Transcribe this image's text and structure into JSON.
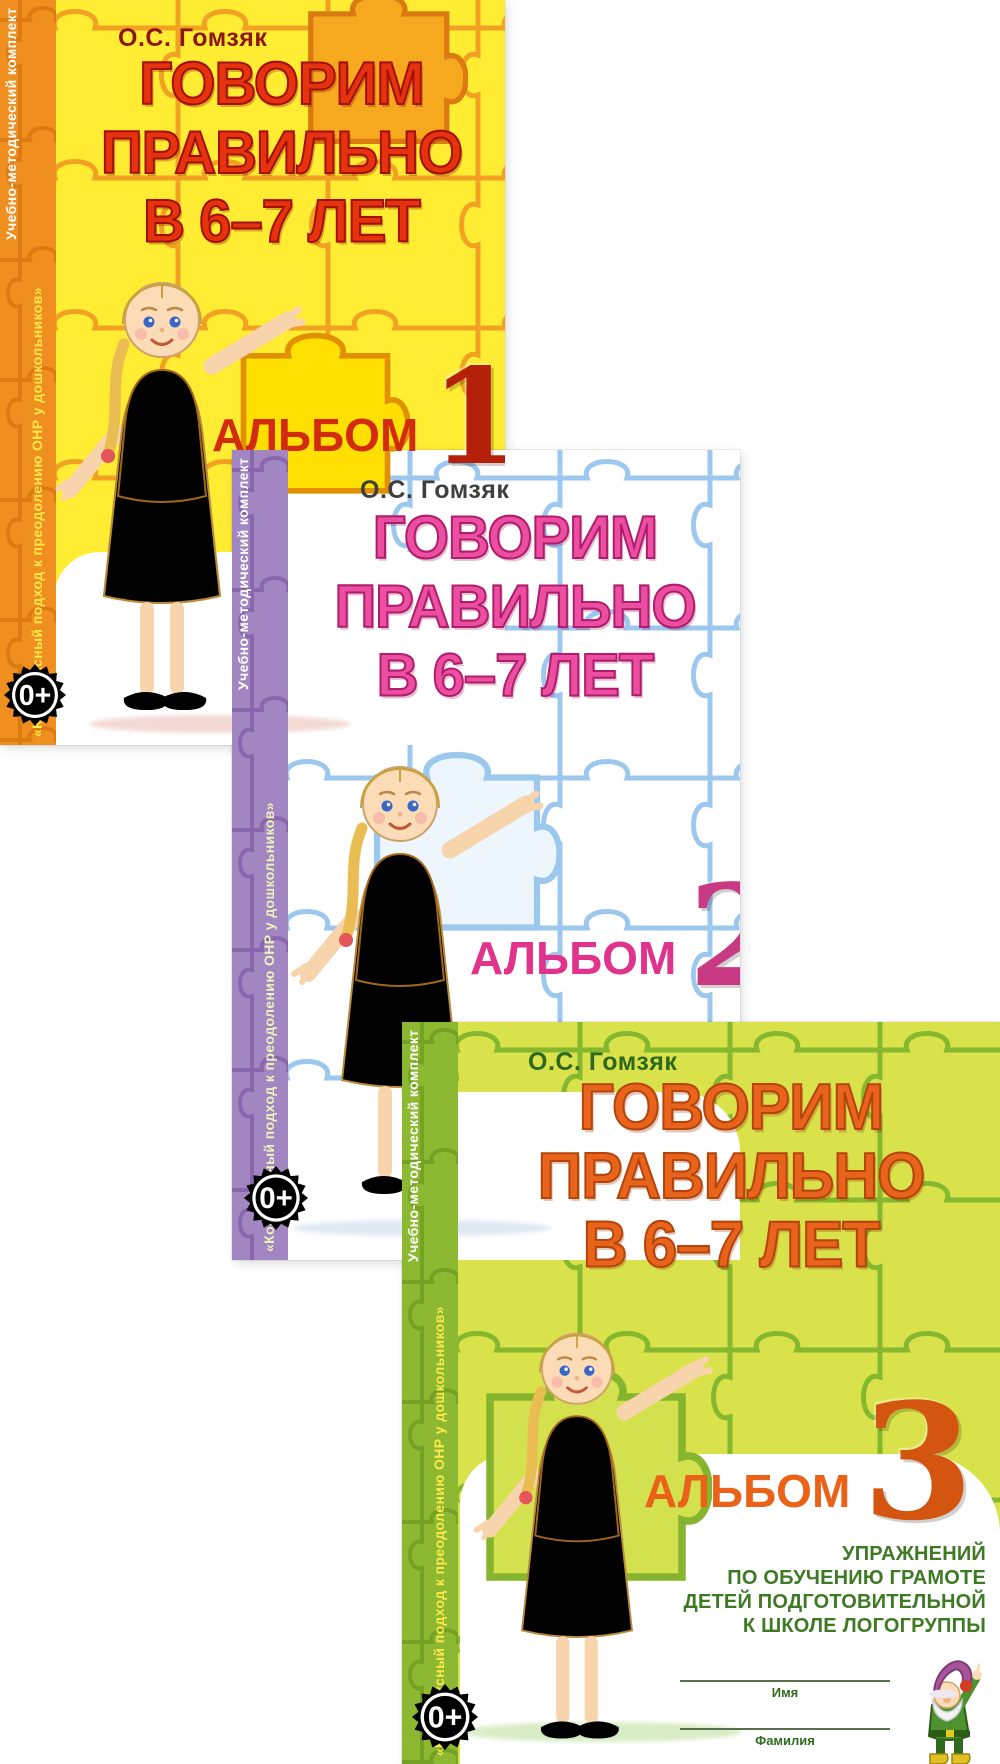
{
  "series": {
    "author": "О.С. Гомзяк",
    "title_lines": [
      "ГОВОРИМ",
      "ПРАВИЛЬНО",
      "В 6–7 ЛЕТ"
    ],
    "sidebar_top_line": "Учебно-методический комплект",
    "sidebar_quote_line": "«Комплексный подход к преодолению ОНР у дошкольников»",
    "album_word": "АЛЬБОМ",
    "age_badge": "0+"
  },
  "albums": [
    {
      "number": "1",
      "accent_color": "#e6330f",
      "background_color": "#ffec33",
      "sidebar_color": "#ef8f1f",
      "badge_color": "#3f9e41"
    },
    {
      "number": "2",
      "accent_color": "#ec4fa0",
      "background_color": "#ffffff",
      "sidebar_color": "#a186c2",
      "badge_color": "#d6252b"
    },
    {
      "number": "3",
      "accent_color": "#e8641c",
      "background_color": "#d9e24b",
      "sidebar_color": "#8cb832",
      "badge_color": "#d6252b",
      "subtitle_lines": [
        "УПРАЖНЕНИЙ",
        "ПО ОБУЧЕНИЮ ГРАМОТЕ",
        "ДЕТЕЙ ПОДГОТОВИТЕЛЬНОЙ",
        "К ШКОЛЕ ЛОГОГРУППЫ"
      ],
      "name_field_label": "Имя",
      "surname_field_label": "Фамилия"
    }
  ]
}
